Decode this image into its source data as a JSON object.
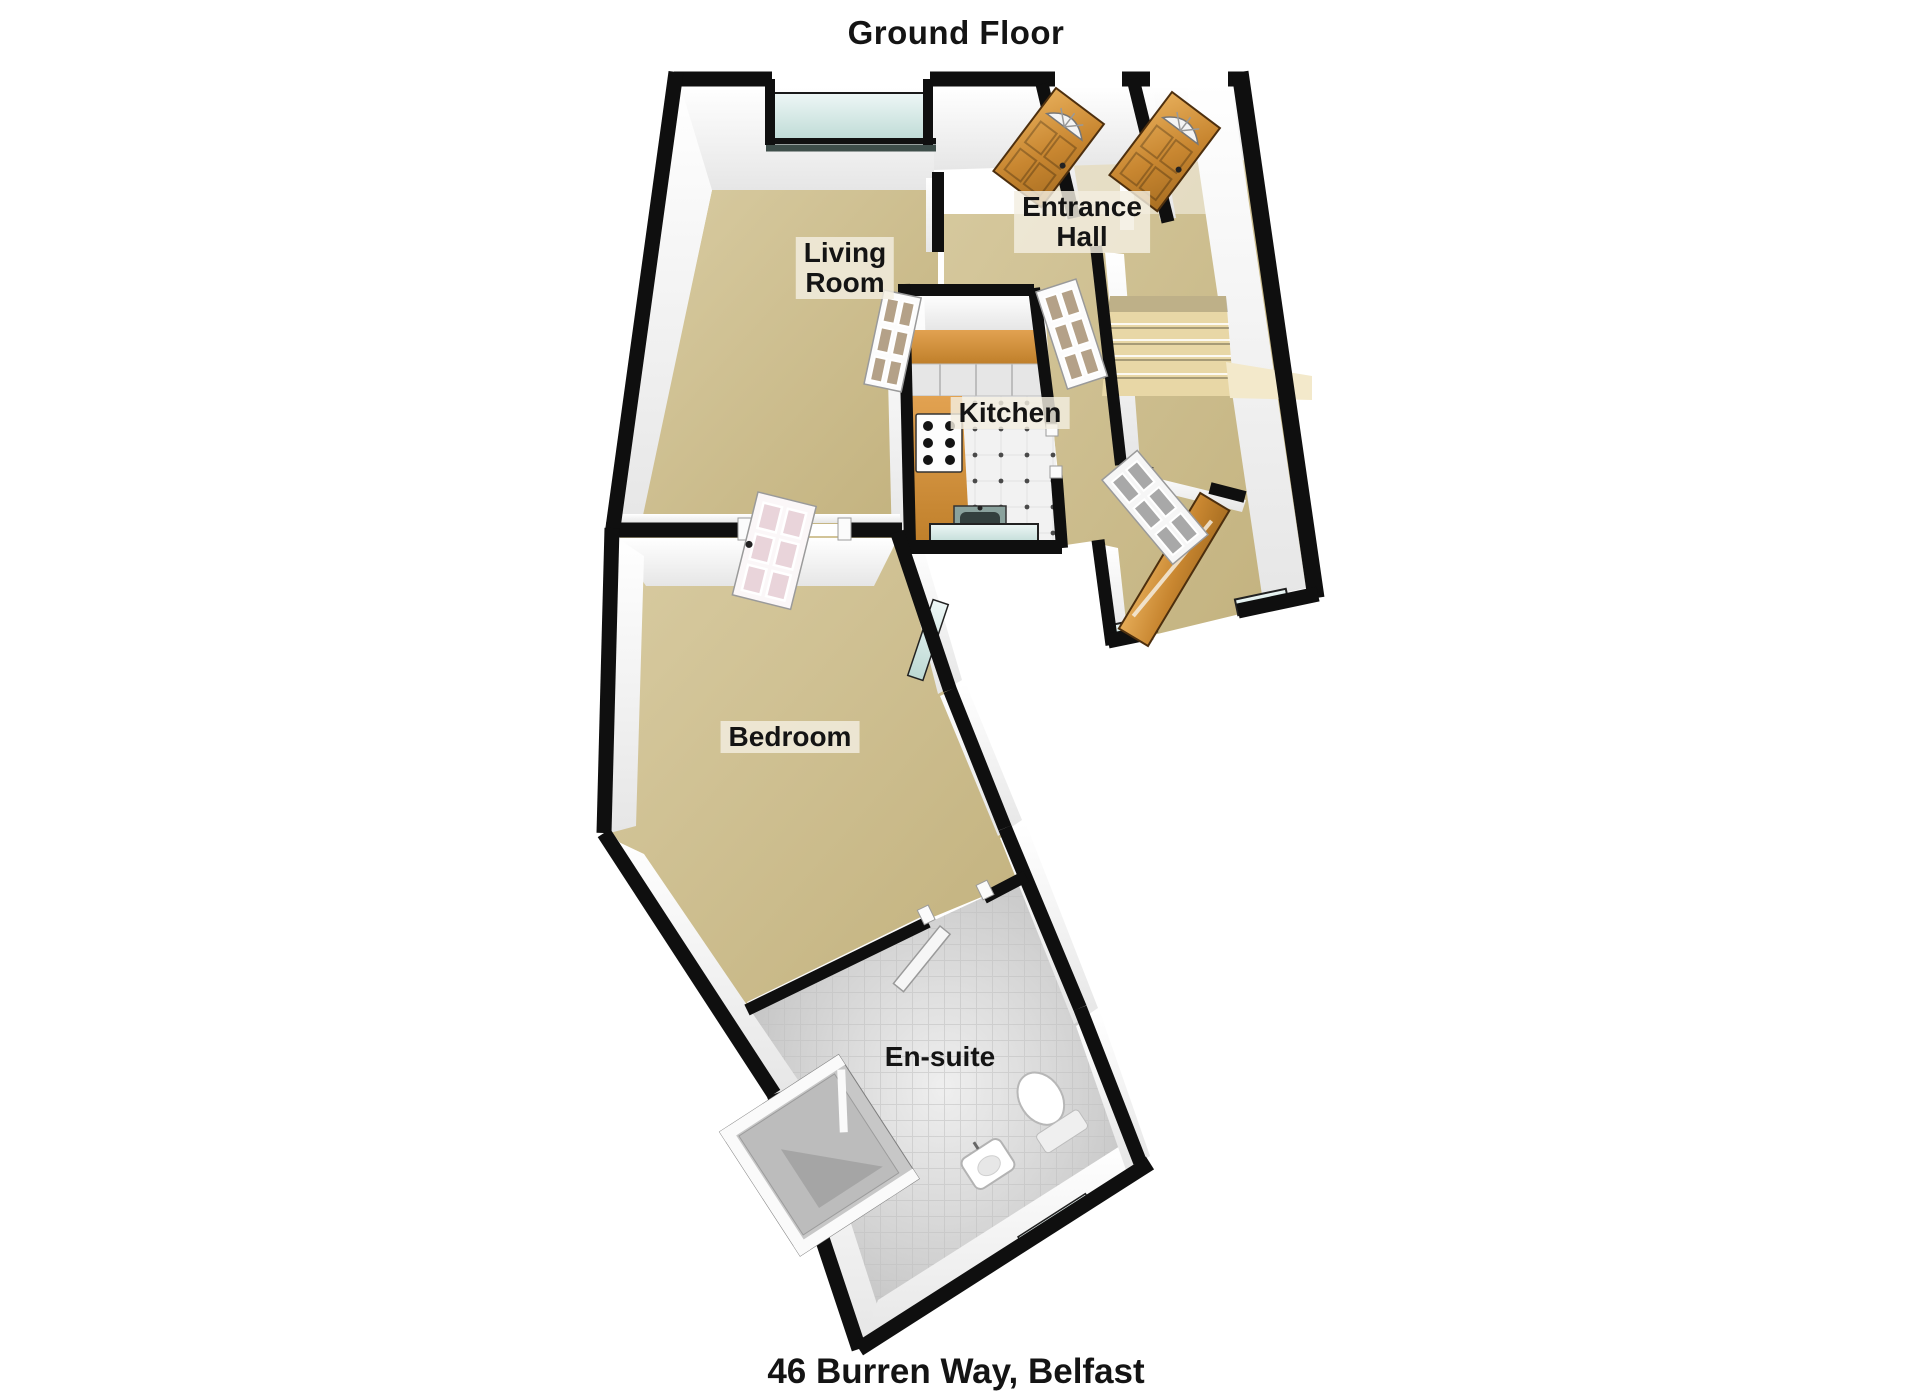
{
  "title": "Ground Floor",
  "address_caption": "46 Burren Way, Belfast",
  "rooms": {
    "living_room": {
      "line1": "Living",
      "line2": "Room"
    },
    "entrance_hall": {
      "line1": "Entrance",
      "line2": "Hall"
    },
    "kitchen": {
      "label": "Kitchen"
    },
    "bedroom": {
      "label": "Bedroom"
    },
    "ensuite": {
      "label": "En-suite"
    }
  },
  "fixtures": [
    "front-door",
    "neighbour-front-door",
    "back-door",
    "staircase",
    "kitchen-counter",
    "hob",
    "kitchen-sink",
    "bay-window",
    "kitchen-window",
    "bedroom-window",
    "ensuite-window",
    "shower",
    "toilet",
    "wash-basin",
    "glazed-internal-door",
    "bedroom-door",
    "ensuite-door"
  ],
  "colors": {
    "wall": "#0f0f0f",
    "carpet": "#cfc197",
    "kitchen_tile": "#f1f1f1",
    "ensuite_tile": "#d6d6d6",
    "window_glass": "#cfe6e2",
    "wood_door": "#c9893a",
    "counter": "#d3913a",
    "label_bg": "#f2ecdc",
    "text": "#141414"
  }
}
